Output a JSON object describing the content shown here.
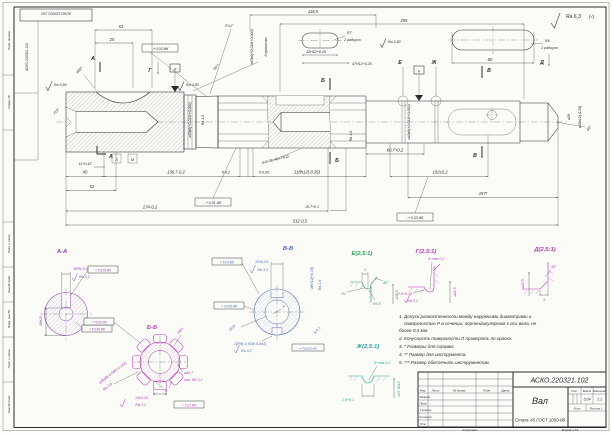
{
  "doc": {
    "number": "АСКО.220321.102",
    "title": "Вал",
    "material": "Сталь 45 ГОСТ 1050-88",
    "mass": "5,04",
    "scale": "1:1",
    "lit_label": "Лит.",
    "mass_label": "Масса",
    "scale_label": "Масштаб",
    "sheet_label": "Лист",
    "sheets_label": "Листов 1",
    "copied_label": "Копировал",
    "format_label": "Формат А3"
  },
  "tb": {
    "c0": "Изм.",
    "c1": "Лист",
    "c2": "№ докум.",
    "c3": "Подп.",
    "c4": "Дата",
    "r0": "Разраб.",
    "r1": "Пров.",
    "r2": "Т.контр.",
    "r3": "Н.контр.",
    "r4": "Утв."
  },
  "frame": {
    "stamp": "АСКО.220321.102",
    "stamp_side": "АСКО.220321.102",
    "s0": "Инв.№ подл.",
    "s1": "Подп. и дата",
    "s2": "Взам. инв.№",
    "s3": "Инв.№ дубл.",
    "s4": "Подп. и дата",
    "s5": "Справ. №",
    "s6": "Перв. примен."
  },
  "rough": {
    "corner": "Ra 6,3",
    "corner_b": "(√)",
    "ra08": "Ra 0,80",
    "ra16": "Ra 1,6"
  },
  "dims": {
    "d118_5": "118,5",
    "d255": "255",
    "d51": "51",
    "d25": "25",
    "r7": "R7",
    "rad2": "2 радиуса",
    "r6": "R6",
    "kw32": "32Н12+0,25",
    "kw47": "47Н12+0,25",
    "d80": "80",
    "ang3": "3°±1°",
    "ang60": "60°*",
    "d38": "⌀38*",
    "ang115": "115°",
    "d30k6": "⌀30к6(+0,015/+0,002)",
    "d45k6": "⌀45к6(+0,018/+0,002)",
    "grooves": "2 проточки",
    "spline": "d-8×36×40×7H12",
    "d40k6": "⌀40к6(+0,018/+0,002)",
    "d29": "⌀29",
    "d40h": "⌀40h12(-0,25)",
    "tip60": "60°",
    "d40l": "40",
    "d52": "52",
    "d11": "11+0,43",
    "d136": "136,7-0,2",
    "d8": "8-0,2",
    "d5": "5-0,06",
    "d118h": "118h12(-0,35)",
    "d607": "60,7+0,2",
    "d102": "102±0,2",
    "d167": "16,7+0,1",
    "d157": "157*",
    "d274": "274-0,2",
    "d512": "512-0,5"
  },
  "marks": {
    "a": "А",
    "b": "Б",
    "v": "В",
    "g": "Г",
    "d": "Д",
    "e": "Е",
    "zh": "Ж",
    "i": "И",
    "k": "К",
    "l": "Л",
    "m": "М",
    "n": "Н",
    "p": "Р"
  },
  "tol": {
    "t0": "↗ 0,03 ИК",
    "t1": "↗ 0,01 ИК",
    "t2": "↗ 0,03 ИК",
    "t3": "= Т0,25 ИК",
    "t4": "= Т0,05 ИК",
    "t5": "= Т0,05 ИК",
    "t6": "= Т0,2 ИК",
    "t7": "= Т0,4 ИК",
    "t8": "= Т0,05 ИК",
    "t9": "= Т0,025 ИК"
  },
  "secAA": {
    "title": "А-А",
    "kw": "8Р9(-0,015/-0,051)",
    "ra": "Ra 3,2",
    "depth": "26h12"
  },
  "secBB": {
    "title": "Б-Б",
    "d36": "⌀36d9(-0,080/-0,142)",
    "ra08": "Ra 0,8",
    "d40": "⌀40*",
    "d427": "⌀42,7",
    "pov": "пов. Ra 3,2",
    "w14": "14±0,24",
    "ra32": "Ra 3,2"
  },
  "secVV": {
    "title": "В-В",
    "t12": "12±0,24",
    "ra32": "Ra 3,2",
    "d8": "⌀8Н12(+0,15)",
    "ra16": "Ra 1,6",
    "t5": "5-0,1",
    "d23": "⌀23*",
    "kw": "12Р9(-0,018/-0,061)",
    "ra32b": "Ra 3,2"
  },
  "detE": {
    "title": "Е(2,5:1)",
    "w3": "3",
    "r1": "R1",
    "r05": "R0,5",
    "ang": "45°",
    "dia": "⌀38,5"
  },
  "detG": {
    "title": "Г(2,5:1)",
    "rmax": "R max 0,2",
    "t19": "1,9+0,14",
    "ra": "Ra 3,2",
    "dia": "⌀42,5"
  },
  "detD": {
    "title": "Д(2,5:1)",
    "ang": "45°",
    "w3": "3",
    "dia": "⌀42,5"
  },
  "detZh": {
    "title": "Ж(2,5:1)",
    "rmax": "R max 0,2",
    "t19": "1,9+0,1",
    "dia": "⌀37,5h12"
  },
  "notes": {
    "n1a": "1. Допуск разностенности между наружными диаметрами и",
    "n1b": "поверхностью Р в сечении, перпендикулярном к оси вала, не",
    "n1c": "более 0,5 мм.",
    "n2": "2. Конусность поверхности Л проверять по краске.",
    "n3": "3. * Размеры для справок.",
    "n4": "4. ** Размер для инструмента.",
    "n5": "5. *** Размер обеспечить инструментом."
  }
}
